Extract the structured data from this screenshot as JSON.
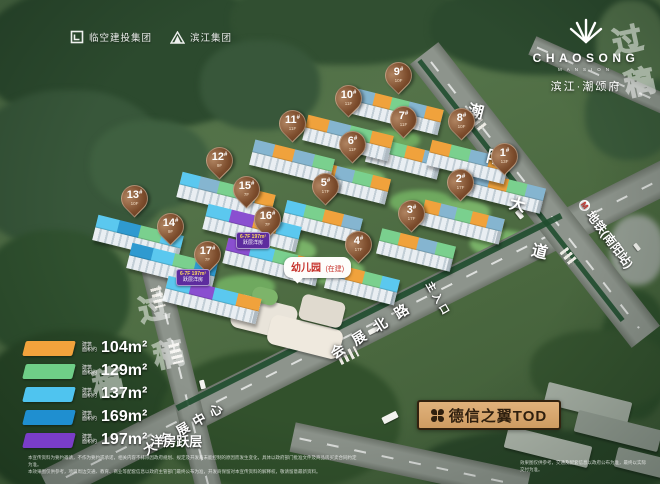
{
  "brand": {
    "developer_logos": [
      {
        "name": "临空建投集团"
      },
      {
        "name": "滨江集团"
      }
    ],
    "project_logo": {
      "en": "CHAOSONG",
      "en_sub": "MANSION",
      "cn": "滨江·潮颂府"
    }
  },
  "map": {
    "pin_suffix": "#",
    "buildings": [
      {
        "no": "1",
        "floors": "13F",
        "x": 504,
        "y": 159
      },
      {
        "no": "2",
        "floors": "17F",
        "x": 460,
        "y": 185
      },
      {
        "no": "3",
        "floors": "17F",
        "x": 411,
        "y": 216
      },
      {
        "no": "4",
        "floors": "17F",
        "x": 358,
        "y": 247
      },
      {
        "no": "5",
        "floors": "17F",
        "x": 325,
        "y": 189
      },
      {
        "no": "6",
        "floors": "11F",
        "x": 352,
        "y": 147
      },
      {
        "no": "7",
        "floors": "11F",
        "x": 403,
        "y": 122
      },
      {
        "no": "8",
        "floors": "10F",
        "x": 461,
        "y": 124
      },
      {
        "no": "9",
        "floors": "10F",
        "x": 398,
        "y": 78
      },
      {
        "no": "10",
        "floors": "11F",
        "x": 348,
        "y": 101
      },
      {
        "no": "11",
        "floors": "11F",
        "x": 292,
        "y": 126
      },
      {
        "no": "12",
        "floors": "9F",
        "x": 219,
        "y": 163
      },
      {
        "no": "13",
        "floors": "10F",
        "x": 134,
        "y": 201
      },
      {
        "no": "14",
        "floors": "9F",
        "x": 170,
        "y": 229
      },
      {
        "no": "15",
        "floors": "7F",
        "x": 246,
        "y": 192
      },
      {
        "no": "16",
        "floors": "7F",
        "x": 267,
        "y": 222
      },
      {
        "no": "17",
        "floors": "7F",
        "x": 207,
        "y": 257
      }
    ],
    "blocks": [
      {
        "x": 506,
        "y": 192,
        "w": 76,
        "roof": [
          "#85b5d0",
          "#f0a23c",
          "#7ad08e",
          "#85b5d0"
        ]
      },
      {
        "x": 462,
        "y": 222,
        "w": 82,
        "roof": [
          "#f0a23c",
          "#85b5d0",
          "#7ad08e",
          "#f0a23c",
          "#85b5d0"
        ]
      },
      {
        "x": 416,
        "y": 250,
        "w": 76,
        "roof": [
          "#7ad08e",
          "#f0a23c",
          "#85b5d0",
          "#7ad08e"
        ]
      },
      {
        "x": 362,
        "y": 284,
        "w": 72,
        "roof": [
          "#85b5d0",
          "#f0a23c",
          "#7ad08e",
          "#5bc8ef"
        ]
      },
      {
        "x": 322,
        "y": 222,
        "w": 78,
        "roof": [
          "#5bc8ef",
          "#7ad08e",
          "#f0a23c",
          "#85b5d0"
        ]
      },
      {
        "x": 352,
        "y": 183,
        "w": 74,
        "roof": [
          "#f0a23c",
          "#85b5d0",
          "#7ad08e",
          "#f0a23c"
        ]
      },
      {
        "x": 404,
        "y": 158,
        "w": 74,
        "roof": [
          "#85b5d0",
          "#7ad08e",
          "#f0a23c",
          "#85b5d0"
        ]
      },
      {
        "x": 468,
        "y": 162,
        "w": 80,
        "roof": [
          "#f0a23c",
          "#7ad08e",
          "#85b5d0",
          "#f0a23c"
        ]
      },
      {
        "x": 398,
        "y": 112,
        "w": 88,
        "roof": [
          "#85b5d0",
          "#f0a23c",
          "#7ad08e",
          "#85b5d0",
          "#f0a23c"
        ]
      },
      {
        "x": 348,
        "y": 138,
        "w": 88,
        "roof": [
          "#f0a23c",
          "#85b5d0",
          "#7ad08e",
          "#f0a23c"
        ]
      },
      {
        "x": 292,
        "y": 162,
        "w": 82,
        "roof": [
          "#85b5d0",
          "#f0a23c",
          "#85b5d0",
          "#7ad08e"
        ]
      },
      {
        "x": 226,
        "y": 196,
        "w": 96,
        "roof": [
          "#5bc8ef",
          "#85b5d0",
          "#7ad08e",
          "#5bc8ef",
          "#f0a23c"
        ]
      },
      {
        "x": 138,
        "y": 238,
        "w": 88,
        "roof": [
          "#5bc8ef",
          "#2f9ad0",
          "#7ad08e",
          "#5bc8ef"
        ]
      },
      {
        "x": 172,
        "y": 266,
        "w": 88,
        "roof": [
          "#2f9ad0",
          "#5bc8ef",
          "#7ad08e",
          "#2f9ad0"
        ]
      },
      {
        "x": 252,
        "y": 228,
        "w": 96,
        "roof": [
          "#5bc8ef",
          "#8a4fd0",
          "#f0a23c",
          "#5bc8ef"
        ]
      },
      {
        "x": 272,
        "y": 262,
        "w": 96,
        "roof": [
          "#8a4fd0",
          "#5bc8ef",
          "#7ad08e",
          "#f0a23c"
        ]
      },
      {
        "x": 212,
        "y": 300,
        "w": 96,
        "roof": [
          "#5bc8ef",
          "#8a4fd0",
          "#5bc8ef",
          "#f0a23c"
        ]
      }
    ],
    "flat_badges": [
      {
        "line1": "6-7F 197m²",
        "line2": "跃层洋房",
        "x": 236,
        "y": 232
      },
      {
        "line1": "6-7F 197m²",
        "line2": "跃层洋房",
        "x": 176,
        "y": 269
      }
    ],
    "roads": {
      "chaoyang": {
        "text": "潮阳大道",
        "char_pos": [
          [
            468,
            98
          ],
          [
            487,
            144
          ],
          [
            510,
            191
          ],
          [
            532,
            238
          ]
        ]
      },
      "huizhan": {
        "text": "会展北路"
      },
      "dahuizhan": {
        "text": "大会展中心"
      },
      "entrance": {
        "text": "主入口"
      },
      "metro": {
        "text": "地铁(南阳站)",
        "icon": "metro-icon"
      }
    },
    "kindergarten": {
      "title": "幼儿园",
      "status": "(在建)"
    }
  },
  "legend": {
    "caption_line1": "建筑",
    "caption_line2": "面积约",
    "items": [
      {
        "color": "#f2a33c",
        "area": "104m²",
        "note": ""
      },
      {
        "color": "#6fce87",
        "area": "129m²",
        "note": ""
      },
      {
        "color": "#4fc4ef",
        "area": "137m²",
        "note": ""
      },
      {
        "color": "#1f8fd0",
        "area": "169m²",
        "note": ""
      },
      {
        "color": "#7a3dc8",
        "area": "197m²",
        "note": "洋房跃层"
      }
    ]
  },
  "tod_badge": {
    "label": "德信之翼TOD"
  },
  "watermark": {
    "glyphs": [
      {
        "ch": "过",
        "x": 612,
        "y": 16
      },
      {
        "ch": "稿",
        "x": 624,
        "y": 58
      },
      {
        "ch": "过",
        "x": 138,
        "y": 284
      },
      {
        "ch": "稿",
        "x": 153,
        "y": 330
      },
      {
        "ch": "稿",
        "x": 92,
        "y": 358
      }
    ]
  },
  "disclaimer": {
    "line1": "本宣传资料为要约邀请，不作为要约或承诺，相关内容不排除因政府规划、规定及开发商未能控制的原因而发生变化，具体以政府部门批准文件及商品房买卖合同约定为准。",
    "line2": "本效果图仅供参考，项目周边交通、教育、商业等配套信息以政府主管部门最终公布为准，开发商保留对本宣传资料的解释权，敬请留意最新资料。",
    "right": "效果图仅供参考，交通及配套信息以政府公布为准，最终以实际交付为准。"
  },
  "scenery": {
    "trees": [
      {
        "x": -20,
        "y": -20,
        "w": 300,
        "h": 150,
        "c": "#2c4a2e"
      },
      {
        "x": -30,
        "y": 90,
        "w": 200,
        "h": 160,
        "c": "#38573a"
      },
      {
        "x": 230,
        "y": -25,
        "w": 230,
        "h": 90,
        "c": "#314f31"
      },
      {
        "x": 430,
        "y": -20,
        "w": 240,
        "h": 95,
        "c": "#2c4a2e"
      },
      {
        "x": 585,
        "y": 70,
        "w": 90,
        "h": 90,
        "c": "#3a5a3a"
      },
      {
        "x": -20,
        "y": 230,
        "w": 150,
        "h": 130,
        "c": "#30512f"
      },
      {
        "x": -25,
        "y": 330,
        "w": 200,
        "h": 170,
        "c": "#294727"
      },
      {
        "x": 160,
        "y": 350,
        "w": 240,
        "h": 140,
        "c": "#32512c"
      },
      {
        "x": 600,
        "y": 290,
        "w": 70,
        "h": 130,
        "c": "#2f4f2c"
      },
      {
        "x": 420,
        "y": 430,
        "w": 250,
        "h": 70,
        "c": "#2a4629"
      },
      {
        "x": 530,
        "y": 330,
        "w": 140,
        "h": 80,
        "c": "#35532f"
      },
      {
        "x": 90,
        "y": 120,
        "w": 120,
        "h": 90,
        "c": "#3f6040"
      },
      {
        "x": 200,
        "y": 40,
        "w": 120,
        "h": 90,
        "c": "#38573a"
      },
      {
        "x": 596,
        "y": 0,
        "w": 70,
        "h": 90,
        "c": "#52704a"
      },
      {
        "x": 610,
        "y": 215,
        "w": 54,
        "h": 70,
        "c": "#949d93"
      }
    ],
    "lawns": [
      {
        "x": 250,
        "y": 238,
        "w": 66,
        "h": 26,
        "c": "#79b268"
      },
      {
        "x": 325,
        "y": 168,
        "w": 60,
        "h": 22,
        "c": "#79b268"
      },
      {
        "x": 390,
        "y": 190,
        "w": 62,
        "h": 24,
        "c": "#6fa95f"
      },
      {
        "x": 300,
        "y": 258,
        "w": 64,
        "h": 26,
        "c": "#79b268"
      },
      {
        "x": 430,
        "y": 200,
        "w": 60,
        "h": 24,
        "c": "#79b268"
      },
      {
        "x": 365,
        "y": 130,
        "w": 55,
        "h": 20,
        "c": "#6fa95f"
      },
      {
        "x": 470,
        "y": 230,
        "w": 60,
        "h": 26,
        "c": "#79b268"
      },
      {
        "x": 215,
        "y": 275,
        "w": 60,
        "h": 24,
        "c": "#6fa95f"
      }
    ],
    "structures": [
      {
        "x": 545,
        "y": 392,
        "w": 86,
        "h": 22,
        "c": "#a9b2a7",
        "rot": 14
      },
      {
        "x": 575,
        "y": 420,
        "w": 86,
        "h": 22,
        "c": "#97a096",
        "rot": 14
      },
      {
        "x": 505,
        "y": 436,
        "w": 86,
        "h": 22,
        "c": "#b1b9ae",
        "rot": 14
      },
      {
        "x": 615,
        "y": 455,
        "w": 70,
        "h": 20,
        "c": "#9aa399",
        "rot": 14
      },
      {
        "x": 232,
        "y": 300,
        "w": 64,
        "h": 34,
        "c": "#e9e4da",
        "rot": 14,
        "r": 8
      },
      {
        "x": 268,
        "y": 322,
        "w": 74,
        "h": 30,
        "c": "#efe9de",
        "rot": 14,
        "r": 8
      },
      {
        "x": 300,
        "y": 298,
        "w": 44,
        "h": 26,
        "c": "#e0dacf",
        "rot": 14,
        "r": 6
      },
      {
        "x": 252,
        "y": 288,
        "w": 26,
        "h": 16,
        "c": "#7db46a",
        "rot": 14,
        "r": 10
      }
    ],
    "zebras": [
      {
        "x": 148,
        "y": 292,
        "w": 20,
        "h": 11,
        "rot": 76
      },
      {
        "x": 166,
        "y": 348,
        "w": 20,
        "h": 11,
        "rot": 76
      },
      {
        "x": 338,
        "y": 350,
        "w": 20,
        "h": 11,
        "rot": -27
      },
      {
        "x": 470,
        "y": 118,
        "w": 18,
        "h": 10,
        "rot": 52
      },
      {
        "x": 560,
        "y": 252,
        "w": 18,
        "h": 10,
        "rot": 52
      }
    ],
    "cars": [
      {
        "x": 515,
        "y": 212,
        "w": 9,
        "h": 5,
        "rot": 52
      },
      {
        "x": 368,
        "y": 328,
        "w": 11,
        "h": 5,
        "rot": -27
      },
      {
        "x": 198,
        "y": 382,
        "w": 9,
        "h": 5,
        "rot": 76
      },
      {
        "x": 382,
        "y": 414,
        "w": 16,
        "h": 7,
        "rot": -27
      },
      {
        "x": 633,
        "y": 245,
        "w": 8,
        "h": 4,
        "rot": 52
      }
    ]
  }
}
